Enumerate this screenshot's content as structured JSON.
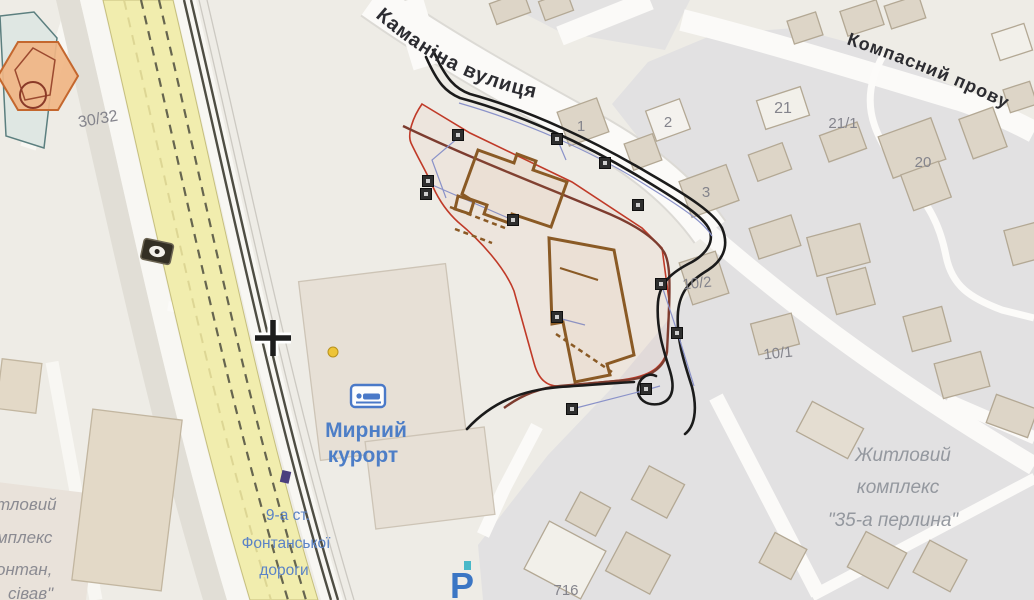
{
  "streets": {
    "kamanina": "Каманіна вулиця",
    "kompasnyi": "Компасний прову"
  },
  "parcel_numbers": {
    "n3032": "30/32",
    "n1": "1",
    "n2": "2",
    "n3": "3",
    "n21": "21",
    "n211": "21/1",
    "n20": "20",
    "n102": "10/2",
    "n101": "10/1",
    "n716": "716"
  },
  "poi": {
    "resort_line1": "Мирний",
    "resort_line2": "курорт",
    "parking": "P"
  },
  "transit_stop": {
    "line1": "9-а ст.",
    "line2": "Фонтанської",
    "line3": "дороги"
  },
  "complexes": {
    "pearl_line1": "Житловий",
    "pearl_line2": "комплекс",
    "pearl_line3": "\"35-а перлина\"",
    "left_partial_line1": "тловий",
    "left_partial_line2": "мплекс",
    "left_partial_line3": "онтан,",
    "left_partial_line4": "сівав\""
  },
  "colors": {
    "site_boundary_red": "#c03a28",
    "planned_building_brown": "#8a5a25",
    "annotation_black": "#1b1b1b",
    "street_redline_maroon": "#7d3c2f",
    "utility_blue": "#8a92c9",
    "tram_road_yellow": "#f1edae",
    "label_blue": "#4d7ec7",
    "label_grey": "#84848c",
    "block_grey": "#e2e1e2",
    "building_beige": "#ddd5c7"
  }
}
